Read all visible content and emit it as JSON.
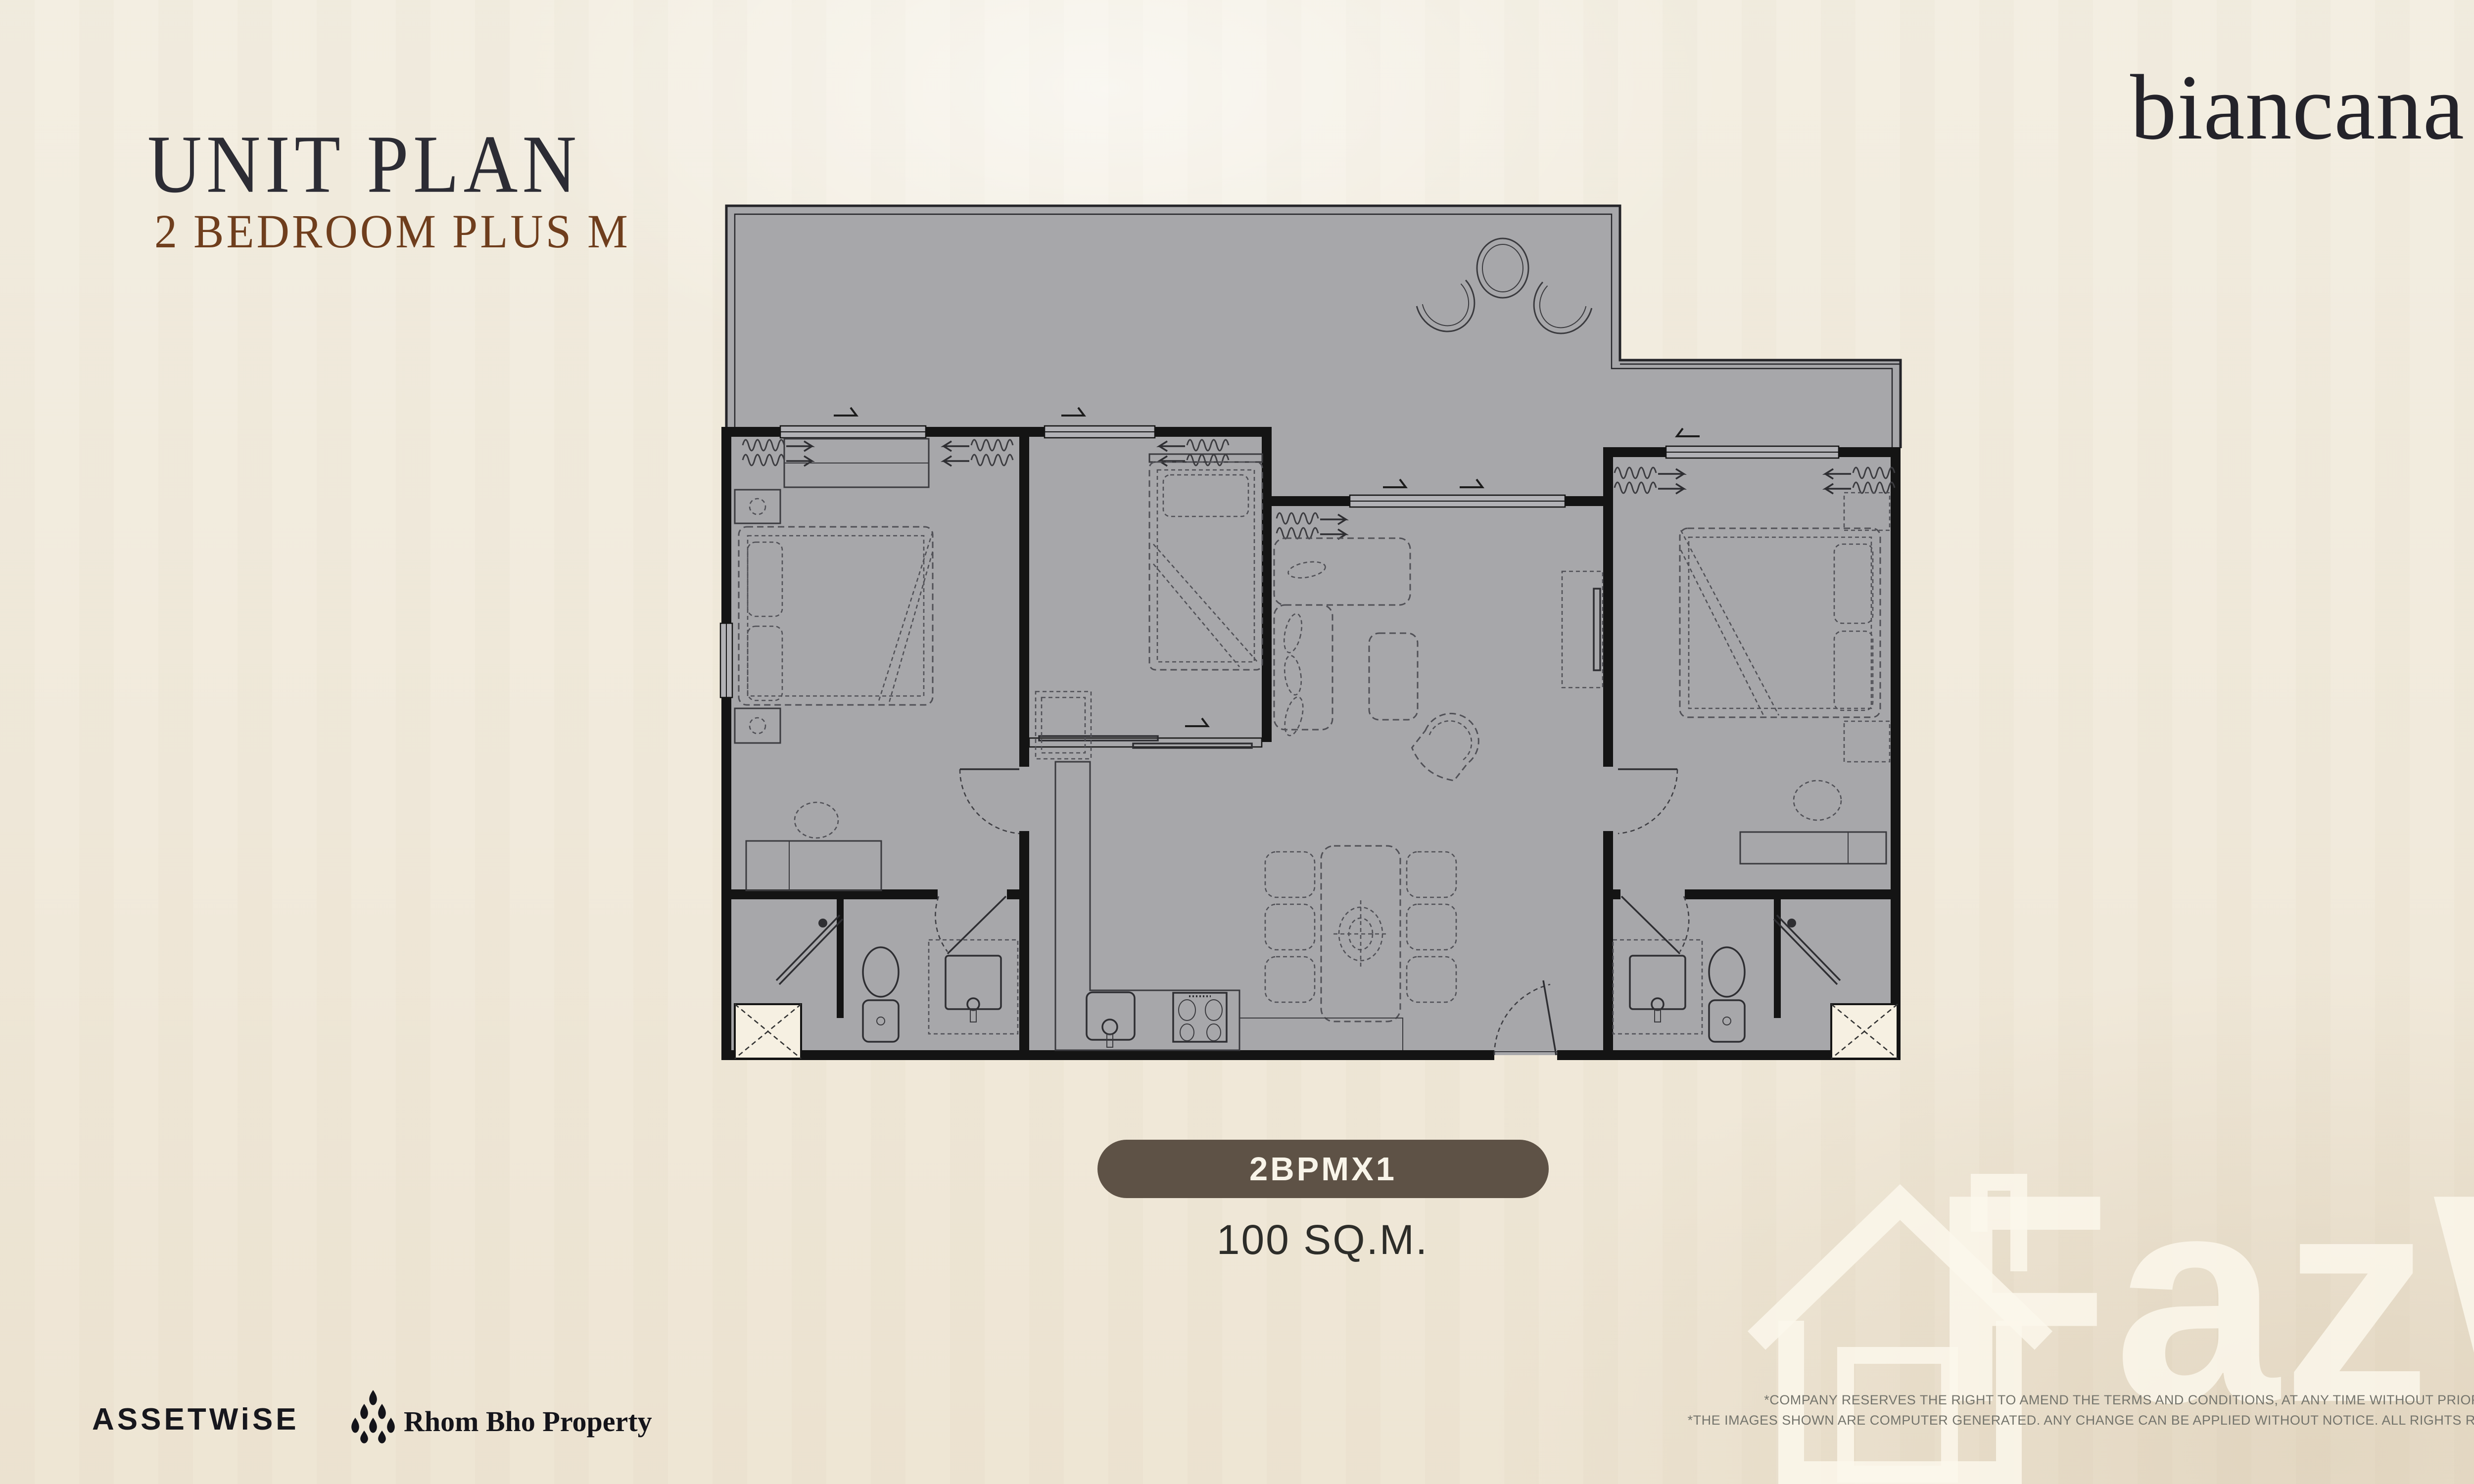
{
  "header": {
    "title": "UNIT PLAN",
    "subtitle": "2 BEDROOM PLUS M",
    "title_color": "#2c2c34",
    "subtitle_color": "#6f3e1d"
  },
  "brand": {
    "logo_text": "biancana",
    "color": "#24232a"
  },
  "unit": {
    "code": "2BPMX1",
    "area_label": "100 SQ.M.",
    "badge_color": "#5e5246",
    "badge_text_color": "#f8f4e9"
  },
  "floor_plan": {
    "fill_color": "#a7a7aa",
    "wall_color": "#141414",
    "furniture_line_color": "#515157"
  },
  "footer": {
    "assetwise_logo": "ASSETWiSE",
    "rhombho_logo": "Rhom Bho Property",
    "disclaimer_line1": "*COMPANY RESERVES THE RIGHT TO AMEND THE TERMS AND CONDITIONS, AT ANY TIME WITHOUT PRIOR NOTICE.",
    "disclaimer_line2": "*THE IMAGES SHOWN ARE COMPUTER GENERATED. ANY CHANGE CAN BE APPLIED WITHOUT NOTICE. ALL RIGHTS RESERVED"
  },
  "watermark": {
    "text": "FazWaz"
  }
}
